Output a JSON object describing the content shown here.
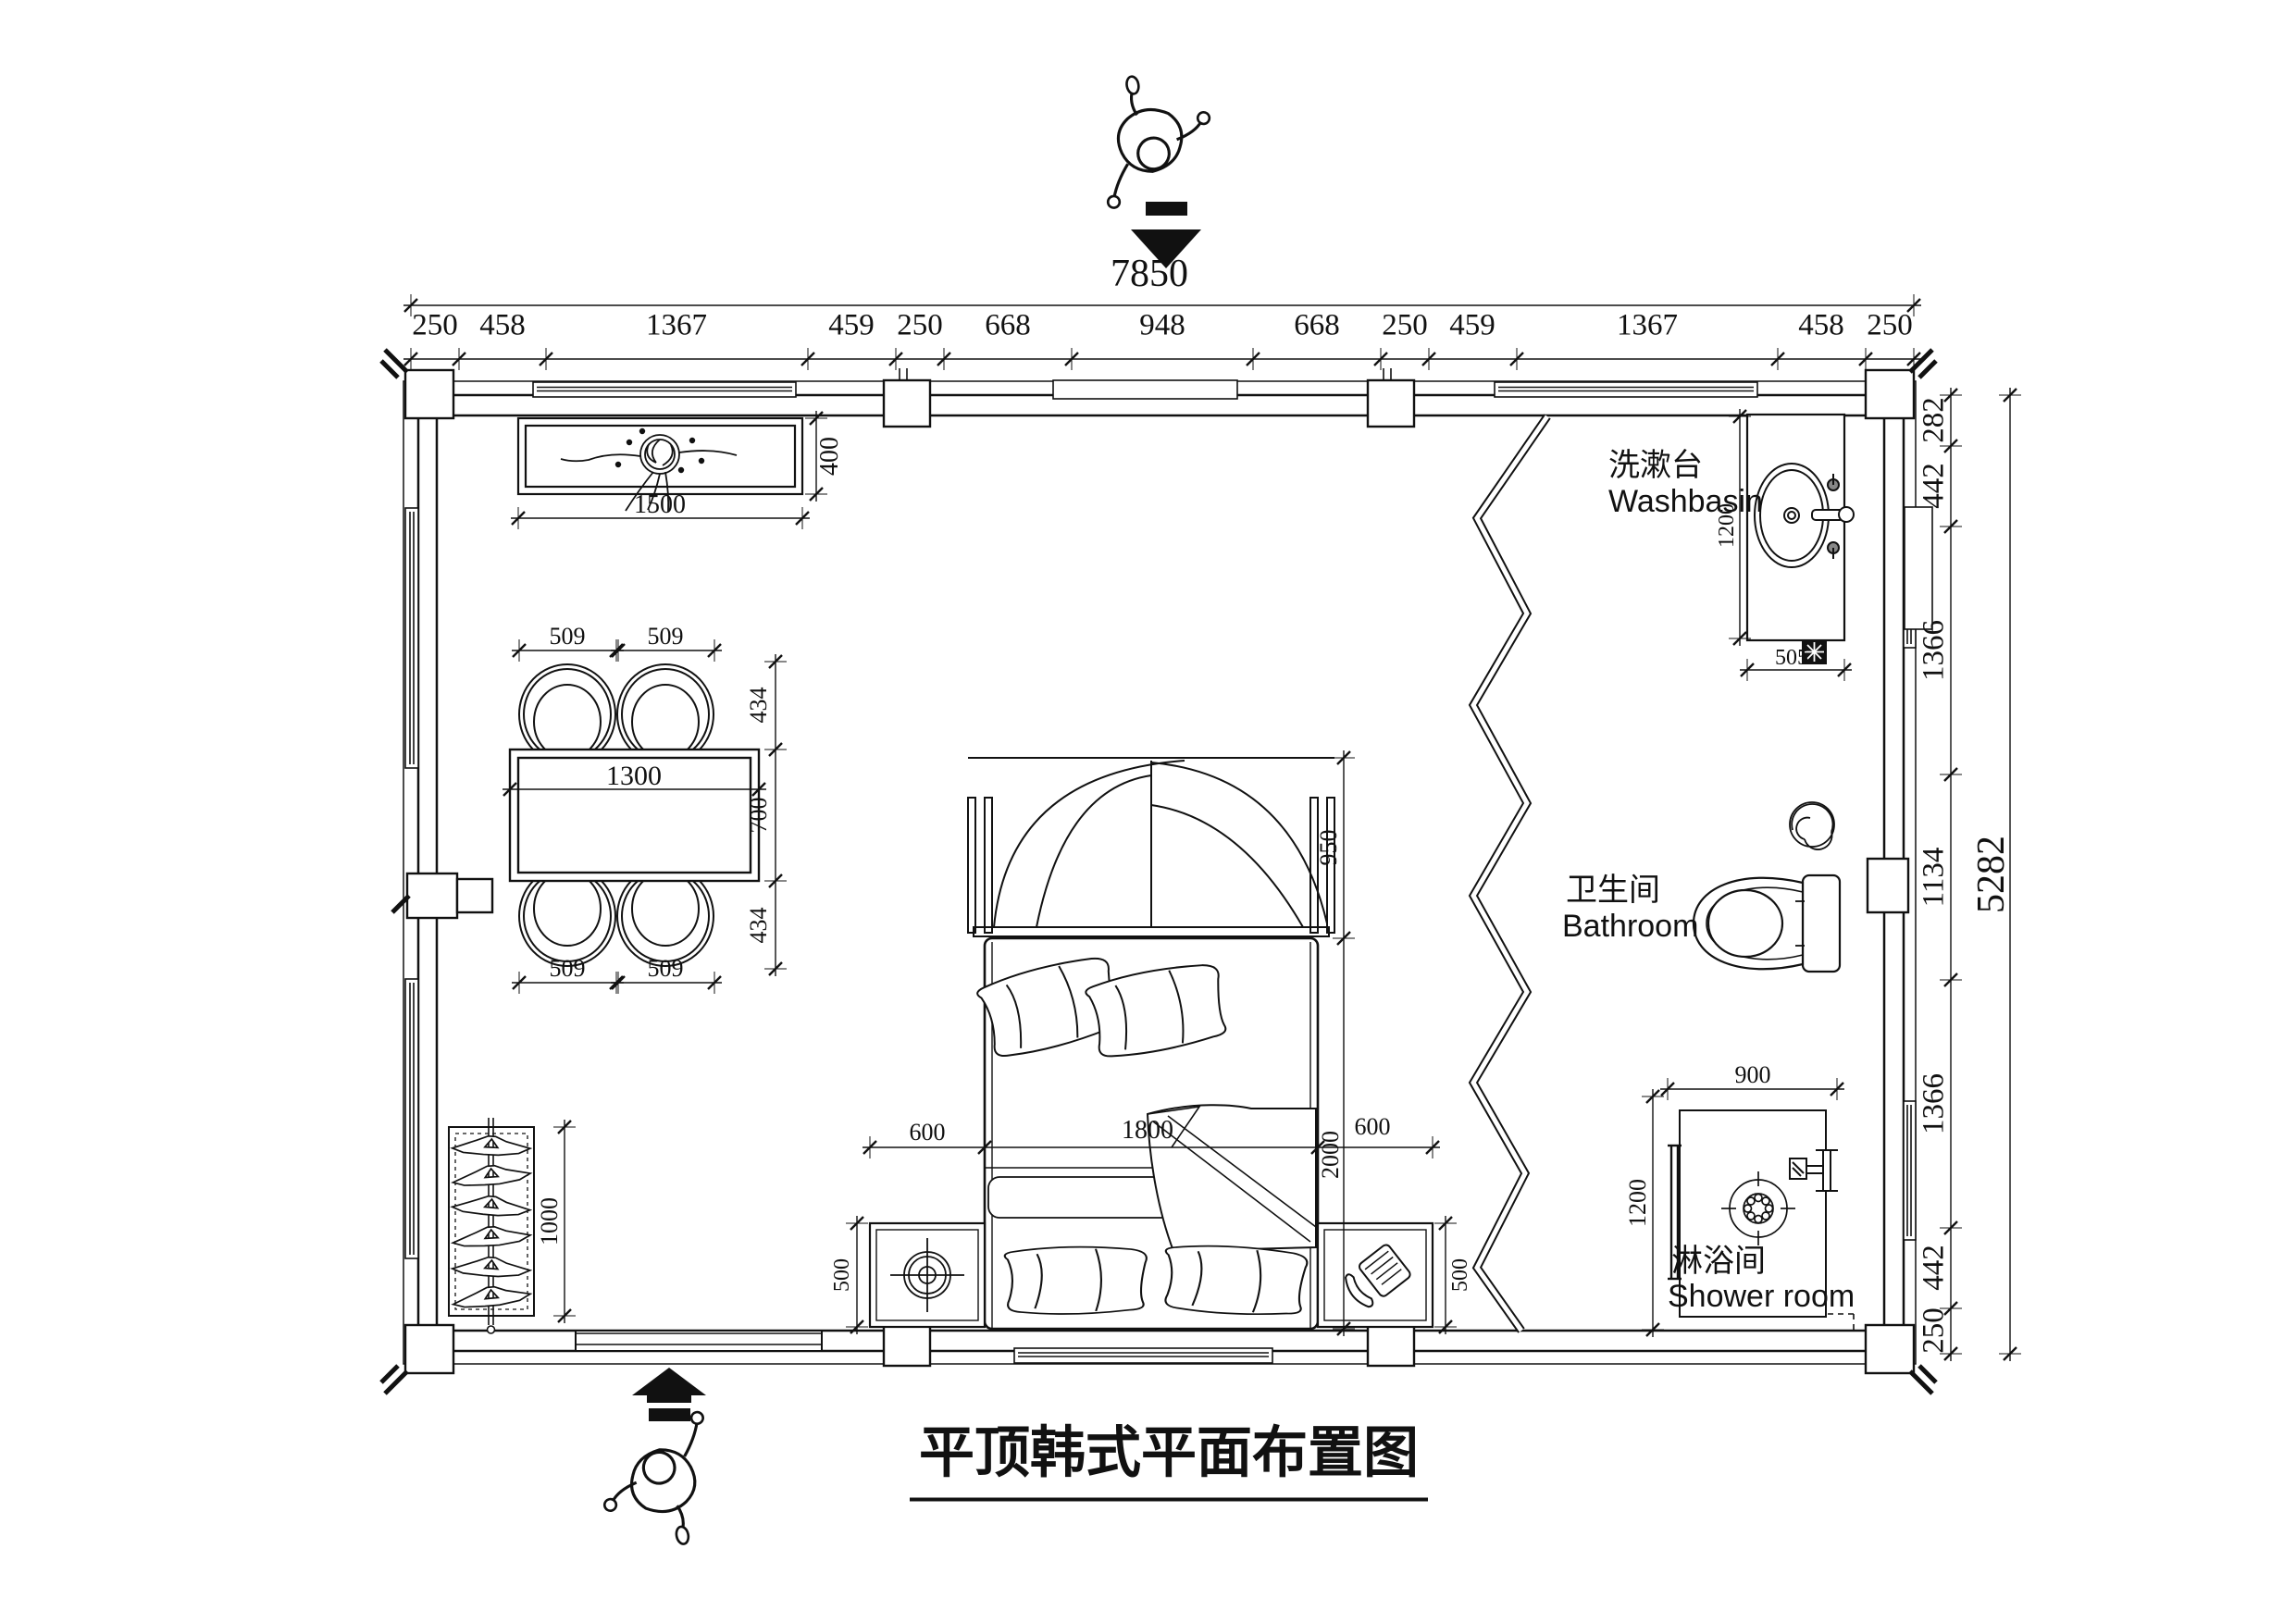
{
  "title": "平顶韩式平面布置图",
  "overall": {
    "width_total": "7850",
    "height_total": "5282"
  },
  "dimensions": {
    "top_chain": [
      "250",
      "458",
      "1367",
      "459",
      "250",
      "668",
      "948",
      "668",
      "250",
      "459",
      "1367",
      "458",
      "250"
    ],
    "right_chain": [
      "282",
      "442",
      "1366",
      "1134",
      "1366",
      "442",
      "250"
    ],
    "console_cabinet": {
      "width": "1500",
      "depth": "400"
    },
    "dining_table": {
      "width": "1300",
      "chair_width_top": [
        "509",
        "509"
      ],
      "chair_width_bottom": [
        "509",
        "509"
      ],
      "side_chain": [
        "434",
        "700",
        "434"
      ]
    },
    "wardrobe_rack": {
      "length": "1000"
    },
    "bed_zone": {
      "headboard_depth": "950",
      "bed_length": "2000",
      "left_gap": "600",
      "bed_width": "1800",
      "right_gap": "600",
      "nightstand_left": "500",
      "nightstand_right": "500"
    },
    "washbasin_counter": {
      "length": "1200",
      "width": "505"
    },
    "shower_cubicle": {
      "width": "900",
      "depth": "1200"
    }
  },
  "rooms": {
    "washbasin": {
      "zh": "洗漱台",
      "en": "Washbasin"
    },
    "bathroom": {
      "zh": "卫生间",
      "en": "Bathroom"
    },
    "shower": {
      "zh": "淋浴间",
      "en": "Shower room"
    }
  },
  "icons": {
    "entry_top": "entry-arrow-down",
    "entry_bottom": "entry-arrow-up",
    "person": "person-top-view",
    "plant": "potted-plant",
    "lamp": "table-lamp",
    "phone": "telephone",
    "fan": "exhaust-fan-swirl",
    "drain": "floor-drain",
    "shower_head": "shower-head"
  }
}
